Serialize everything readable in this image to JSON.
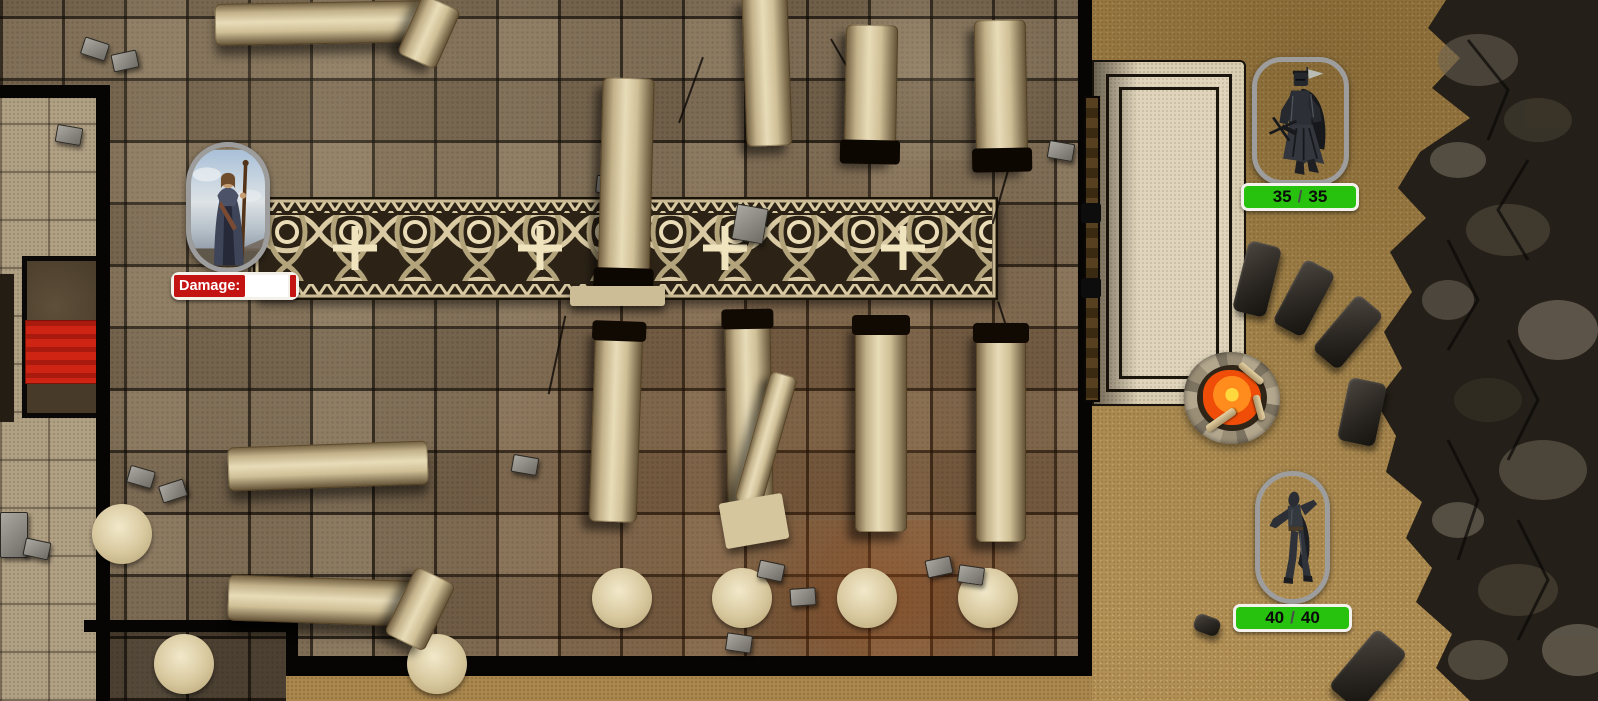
{
  "colors": {
    "health_bar_green": "#27c20d",
    "bar_frame_white": "#f4f2ec",
    "damage_red": "#c41313",
    "token_border_gray": "#9d9d9d",
    "floor_brown": "#7e6b52",
    "sand": "#ad8b51",
    "cliff_dark": "#241f18",
    "altar_cloth_red": "#cf2413"
  },
  "tokens": {
    "mage": {
      "damage_field": {
        "label": "Damage:",
        "value": ""
      }
    },
    "knight": {
      "hp": {
        "current": "35",
        "separator": "/",
        "max": "35"
      }
    },
    "rogue": {
      "hp": {
        "current": "40",
        "separator": "/",
        "max": "40"
      }
    }
  },
  "icons": {
    "mage": "robed-mage-portrait",
    "knight": "black-knight-figure",
    "rogue": "hooded-rogue-figure",
    "campfire": "campfire",
    "bench": "stone-bench",
    "column": "fallen-column",
    "rug": "celtic-knot-runner"
  }
}
